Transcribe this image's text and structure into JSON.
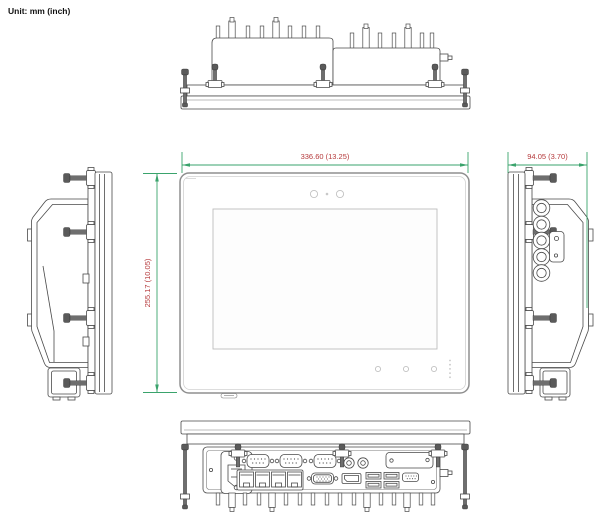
{
  "unit_label": "Unit: mm (inch)",
  "dimensions": {
    "width": {
      "mm": "336.60",
      "inch": "13.25",
      "label": "336.60 (13.25)"
    },
    "height": {
      "mm": "255.17",
      "inch": "10.05",
      "label": "255.17 (10.05)"
    },
    "depth": {
      "mm": "94.05",
      "inch": "3.70",
      "label": "94.05 (3.70)"
    }
  },
  "views": {
    "top": "top view",
    "front": "front view",
    "left": "left side view",
    "right": "right side view",
    "bottom": "bottom view"
  },
  "features": {
    "front": [
      "sensor-circle-left",
      "center-dot",
      "sensor-circle-right",
      "touch-button-1",
      "touch-button-2",
      "touch-button-3",
      "led-dot-column",
      "bottom-tab"
    ],
    "right_side": [
      "m12-connector-1",
      "m12-connector-2",
      "m12-connector-3",
      "m12-connector-4",
      "m12-connector-5",
      "screw-plate"
    ],
    "bottom_io": [
      "ac-power-inlet",
      "com-port-1",
      "com-port-2",
      "com-port-3",
      "audio-jack-1",
      "audio-jack-2",
      "expansion-plate",
      "lan-port-x4",
      "vga-port",
      "displayport",
      "usb-port-x4",
      "dio-port",
      "antenna-stub"
    ],
    "mounting": [
      "panel-mount-clamps",
      "corner-screws",
      "heatsink-fins"
    ]
  },
  "colors": {
    "background": "#ffffff",
    "line_art": "#4a4a4a",
    "dimension_line": "#3aa36c",
    "dimension_text": "#b5393b"
  }
}
